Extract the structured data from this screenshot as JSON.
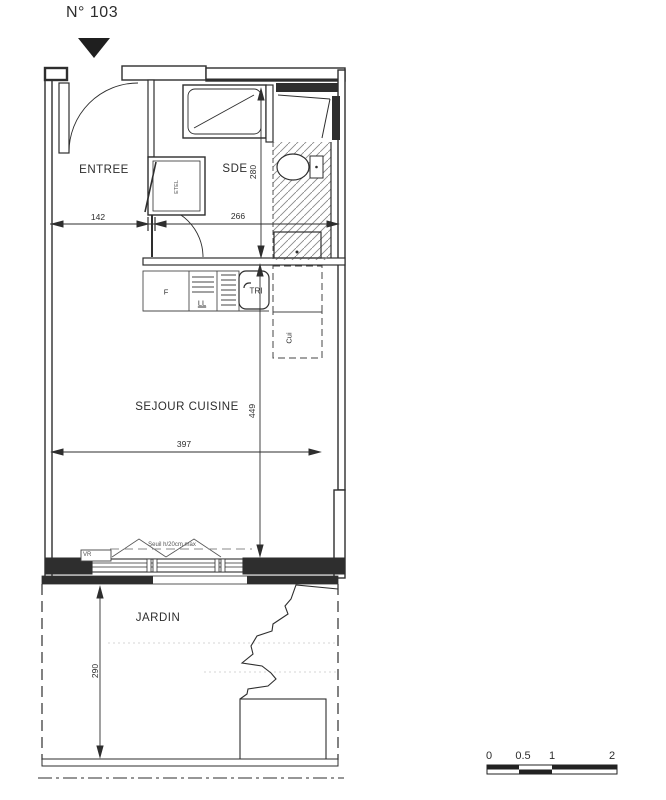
{
  "title": "N° 103",
  "plan": {
    "rooms": {
      "entree": "ENTREE",
      "sde": "SDE",
      "sejour_cuisine": "SEJOUR CUISINE",
      "jardin": "JARDIN"
    },
    "fixtures": {
      "etel": "ETEL",
      "fridge": "F",
      "washing_machine": "LL",
      "tri_bin": "TRI",
      "kitchen_column": "Cui",
      "roller_shutter": "VR"
    },
    "notes": {
      "threshold": "Seuil h/20cm max"
    },
    "dimensions_cm": {
      "entree_width": "142",
      "sde_width": "266",
      "sde_depth": "280",
      "sejour_width": "397",
      "sejour_depth": "449",
      "jardin_depth": "290"
    }
  },
  "scale_bar": {
    "ticks": [
      "0",
      "0.5",
      "1",
      "2"
    ]
  },
  "colors": {
    "line": "#2e2e2e",
    "fill": "#ffffff",
    "hatch": "#8a8a8a",
    "muted": "#666666"
  }
}
